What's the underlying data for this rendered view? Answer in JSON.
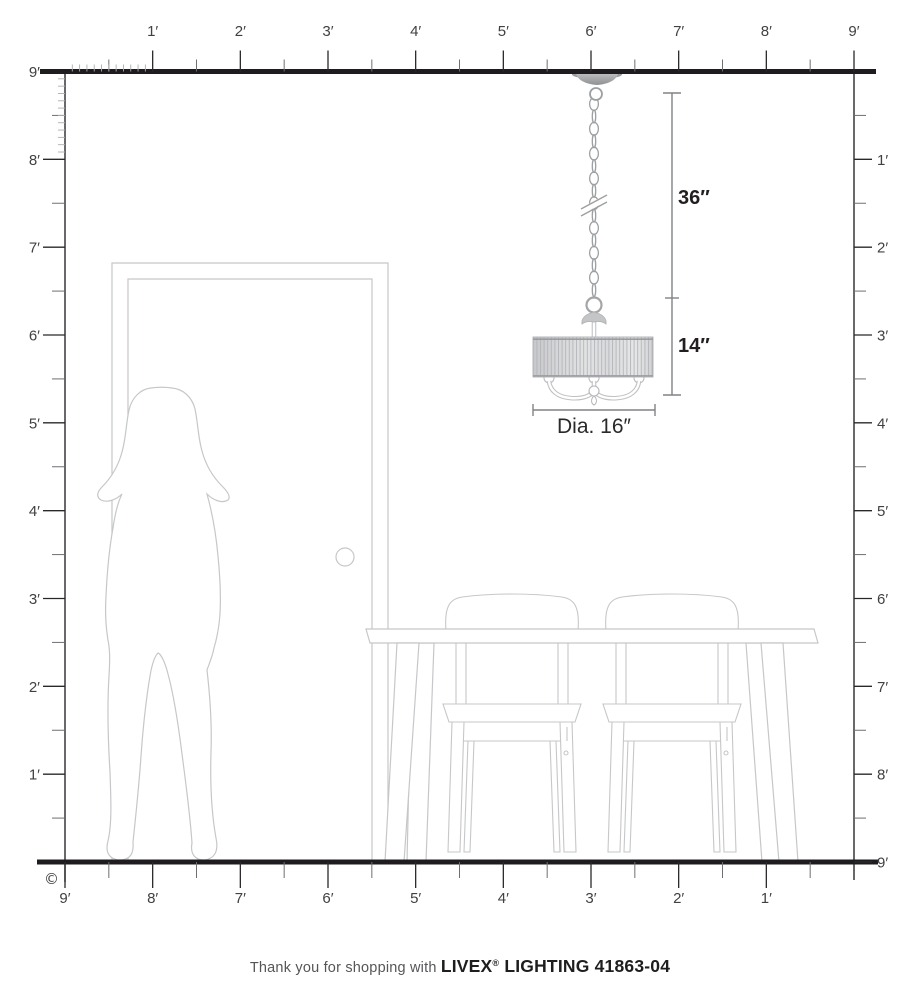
{
  "page": {
    "copyright_symbol": "©"
  },
  "rulers": {
    "top": {
      "labels": [
        "1′",
        "2′",
        "3′",
        "4′",
        "5′",
        "6′",
        "7′",
        "8′",
        "9′"
      ]
    },
    "left": {
      "labels": [
        "9′",
        "8′",
        "7′",
        "6′",
        "5′",
        "4′",
        "3′",
        "2′",
        "1′"
      ]
    },
    "right": {
      "labels": [
        "1′",
        "2′",
        "3′",
        "4′",
        "5′",
        "6′",
        "7′",
        "8′",
        "9′"
      ]
    },
    "bottom": {
      "labels": [
        "9′",
        "8′",
        "7′",
        "6′",
        "5′",
        "4′",
        "3′",
        "2′",
        "1′"
      ]
    }
  },
  "fixture": {
    "chain_length_label": "36″",
    "height_label": "14″",
    "diameter_label": "Dia. 16″"
  },
  "footer": {
    "prefix": "Thank you for shopping with",
    "brand": "LIVEX",
    "registered_mark": "®",
    "product": "LIGHTING 41863-04"
  },
  "colors": {
    "ruler_line": "#2a282b",
    "thick_line": "#1e1c1e",
    "mid_tick": "#6e6f72",
    "light_tick": "#abadaf",
    "line_art": "#c6c7c9",
    "dimension_line": "#808285",
    "text_dark": "#231f20"
  }
}
